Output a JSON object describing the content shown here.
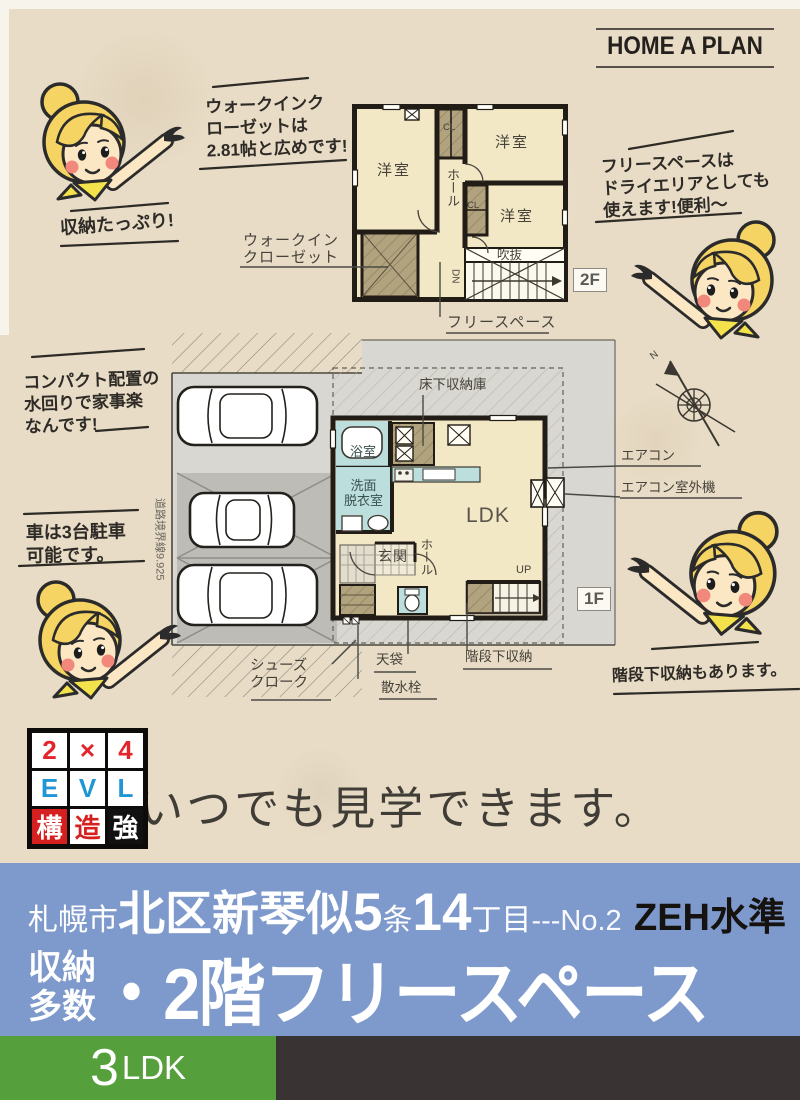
{
  "colors": {
    "paper": "#e8dcc6",
    "banner_blue": "#7e99cb",
    "green": "#55a03c",
    "dark_bar": "#393433",
    "accent_red": "#d6201f",
    "accent_blue": "#2196d4",
    "wall": "#211c16",
    "room_cream": "#f2e8c6",
    "closet_tan": "#b2a37f",
    "water_blue": "#bcdedd"
  },
  "logo": {
    "text": "HOME A PLAN"
  },
  "speech": {
    "wic": "ウォークインク\nローゼットは\n2.81帖と広めです!",
    "storage": "収納たっぷり!",
    "freespace": "フリースペースは\nドライエリアとしても\n使えます!便利〜",
    "compact": "コンパクト配置の\n水回りで家事楽\nなんです!",
    "cars": "車は3台駐車\n可能です。",
    "understair": "階段下収納もあります。"
  },
  "plan2f": {
    "floor_badge": "2F",
    "rooms": {
      "yoshitsu1": "洋室",
      "yoshitsu2": "洋室",
      "yoshitsu3": "洋室",
      "hall": "ホール",
      "cl1": "CL",
      "cl2": "CL",
      "fukinuke": "吹抜",
      "dn": "DN"
    },
    "labels": {
      "wic": "ウォークイン\nクローゼット",
      "freespace": "フリースペース"
    }
  },
  "plan1f": {
    "floor_badge": "1F",
    "rooms": {
      "bath": "浴室",
      "senmen": "洗面\n脱衣室",
      "genkan": "玄関",
      "hall": "ホール",
      "ldk": "LDK",
      "up": "UP"
    },
    "labels": {
      "yukashita": "床下収納庫",
      "aircon": "エアコン",
      "aircon_out": "エアコン室外機",
      "shoes": "シューズ\nクローク",
      "tenbukuro": "天袋",
      "sansui": "散水栓",
      "kaidanshita": "階段下収納",
      "road": "道路境界線9.925",
      "north": "N"
    }
  },
  "structure_logo": {
    "cells": [
      "2",
      "×",
      "4",
      "E",
      "V",
      "L",
      "構",
      "造",
      "強"
    ]
  },
  "message": {
    "text": "いつでも見学できます。"
  },
  "banner": {
    "city": "札幌市",
    "district": "北区新琴似",
    "five": "5",
    "jo": "条",
    "block": "14",
    "chome": "丁目",
    "no": "---No.2",
    "zeh": "ZEH水準",
    "sub1": "収納",
    "sub2": "多数",
    "main": "・2階フリースペース"
  },
  "footer": {
    "num": "3",
    "type": "LDK"
  }
}
